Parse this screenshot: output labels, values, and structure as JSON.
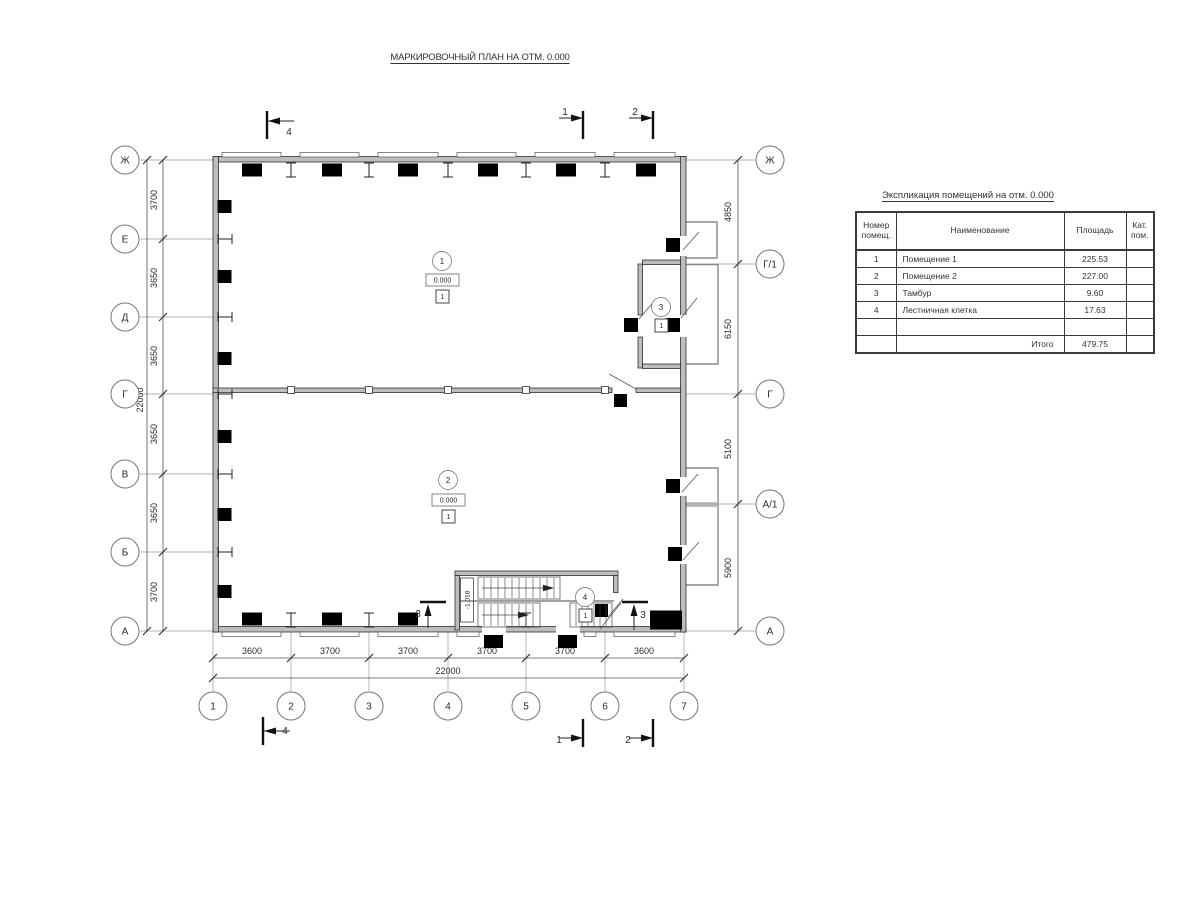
{
  "page": {
    "title": "МАРКИРОВОЧНЫЙ ПЛАН НА ОТМ. 0.000"
  },
  "spec_table": {
    "title": "Экспликация помещений на отм. 0.000",
    "col_num": "Номер помещ.",
    "col_name": "Наименование",
    "col_area": "Площадь",
    "col_cat": "Кат. пом.",
    "rows": [
      {
        "num": "1",
        "name": "Помещение 1",
        "area": "225.53",
        "cat": ""
      },
      {
        "num": "2",
        "name": "Помещение 2",
        "area": "227.00",
        "cat": ""
      },
      {
        "num": "3",
        "name": "Тамбур",
        "area": "9.60",
        "cat": ""
      },
      {
        "num": "4",
        "name": "Лестничная клетка",
        "area": "17.63",
        "cat": ""
      },
      {
        "num": "",
        "name": "",
        "area": "",
        "cat": ""
      }
    ],
    "total_label": "Итого",
    "total_area": "479.75"
  },
  "axes": {
    "left": [
      "Ж",
      "Е",
      "Д",
      "Г",
      "В",
      "Б",
      "А"
    ],
    "right": [
      "Ж",
      "Г/1",
      "Г",
      "А/1",
      "А"
    ],
    "bottom": [
      "1",
      "2",
      "3",
      "4",
      "5",
      "6",
      "7"
    ]
  },
  "dimensions": {
    "left_segments": [
      "3700",
      "3650",
      "3650",
      "3650",
      "3650",
      "3700"
    ],
    "left_total": "22000",
    "bottom_segments": [
      "3600",
      "3700",
      "3700",
      "3700",
      "3700",
      "3600"
    ],
    "bottom_total": "22000",
    "right_segments": [
      "4850",
      "6150",
      "5100",
      "5900"
    ]
  },
  "rooms": {
    "room1": {
      "number": "1",
      "elevation": "0.000",
      "floor_mark": "1"
    },
    "room2": {
      "number": "2",
      "elevation": "0.000",
      "floor_mark": "1"
    },
    "room3": {
      "number": "3",
      "floor_mark": "1"
    },
    "room4": {
      "number": "4",
      "floor_mark": "1"
    }
  },
  "stair": {
    "landing_elevation": "-1.018"
  },
  "sections": {
    "top_left": "4",
    "top_mid": "1",
    "top_right": "2",
    "bottom_left": "4",
    "bottom_mid": "1",
    "bottom_right": "2",
    "stair_left": "3",
    "stair_right": "3"
  }
}
